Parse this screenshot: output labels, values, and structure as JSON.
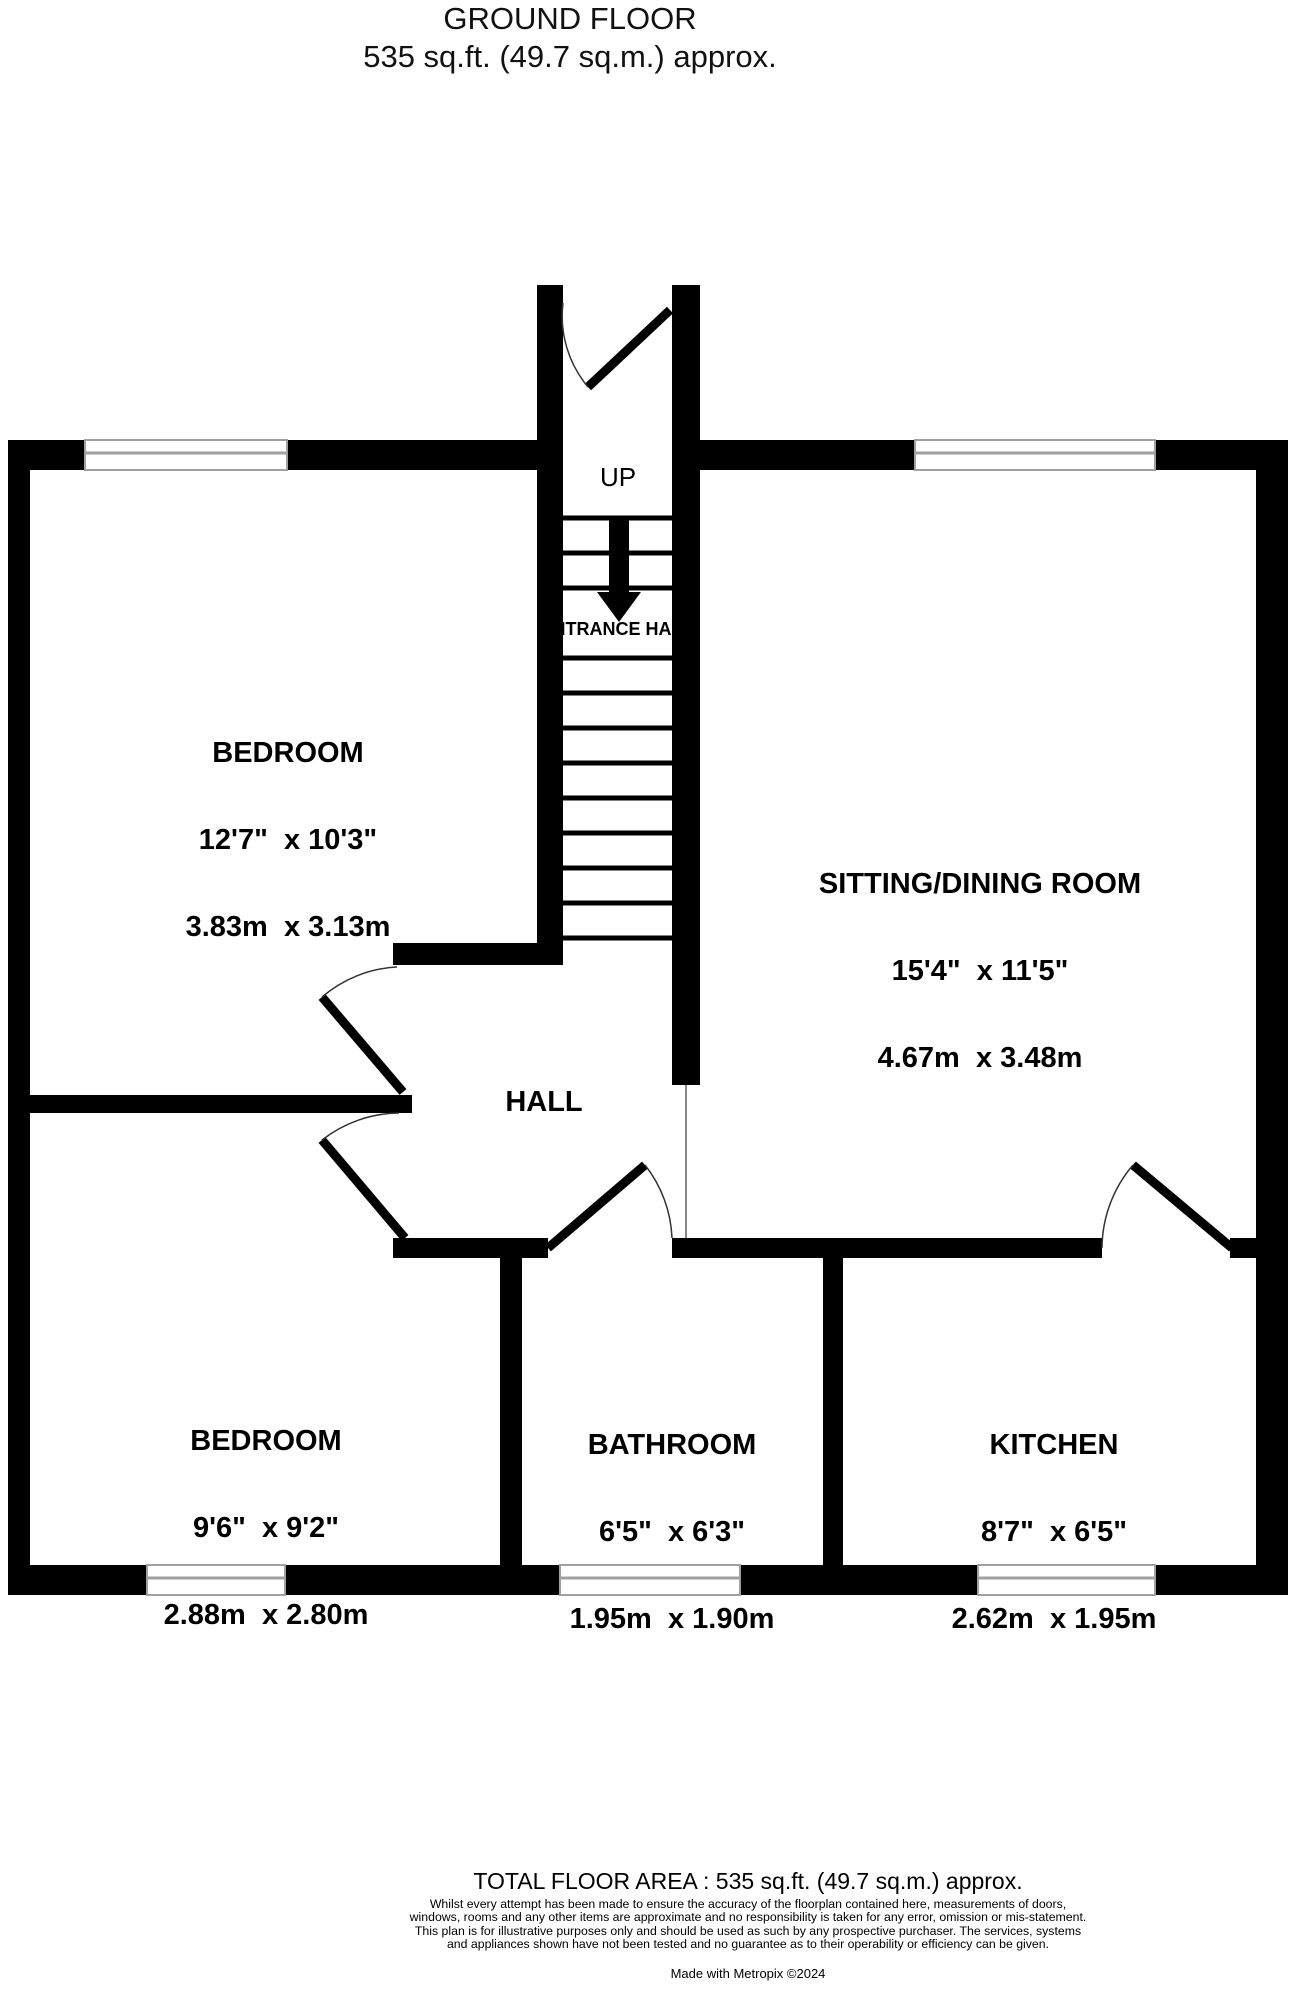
{
  "title": {
    "line1": "GROUND FLOOR",
    "line2": "535 sq.ft. (49.7 sq.m.) approx."
  },
  "stairs": {
    "up_label": "UP"
  },
  "rooms": {
    "entrance_hall": {
      "name": "ENTRANCE HALL"
    },
    "bedroom1": {
      "name": "BEDROOM",
      "imperial": "12'7\"  x 10'3\"",
      "metric": "3.83m  x 3.13m"
    },
    "sitting_dining": {
      "name": "SITTING/DINING ROOM",
      "imperial": "15'4\"  x 11'5\"",
      "metric": "4.67m  x 3.48m"
    },
    "hall": {
      "name": "HALL"
    },
    "bedroom2": {
      "name": "BEDROOM",
      "imperial": "9'6\"  x 9'2\"",
      "metric": "2.88m  x 2.80m"
    },
    "bathroom": {
      "name": "BATHROOM",
      "imperial": "6'5\"  x 6'3\"",
      "metric": "1.95m  x 1.90m"
    },
    "kitchen": {
      "name": "KITCHEN",
      "imperial": "8'7\"  x 6'5\"",
      "metric": "2.62m  x 1.95m"
    }
  },
  "footer": {
    "total": "TOTAL FLOOR AREA : 535 sq.ft. (49.7 sq.m.) approx.",
    "disclaimer": "Whilst every attempt has been made to ensure the accuracy of the floorplan contained here, measurements of doors, windows, rooms and any other items are approximate and no responsibility is taken for any error, omission or mis-statement. This plan is for illustrative purposes only and should be used as such by any prospective purchaser. The services, systems and appliances shown have not been tested and no guarantee as to their operability or efficiency can be given.",
    "credit": "Made with Metropix ©2024"
  },
  "colors": {
    "wall": "#000000",
    "window_line": "#a0a0a0",
    "door_arc": "#333333",
    "open_boundary": "#888888"
  }
}
